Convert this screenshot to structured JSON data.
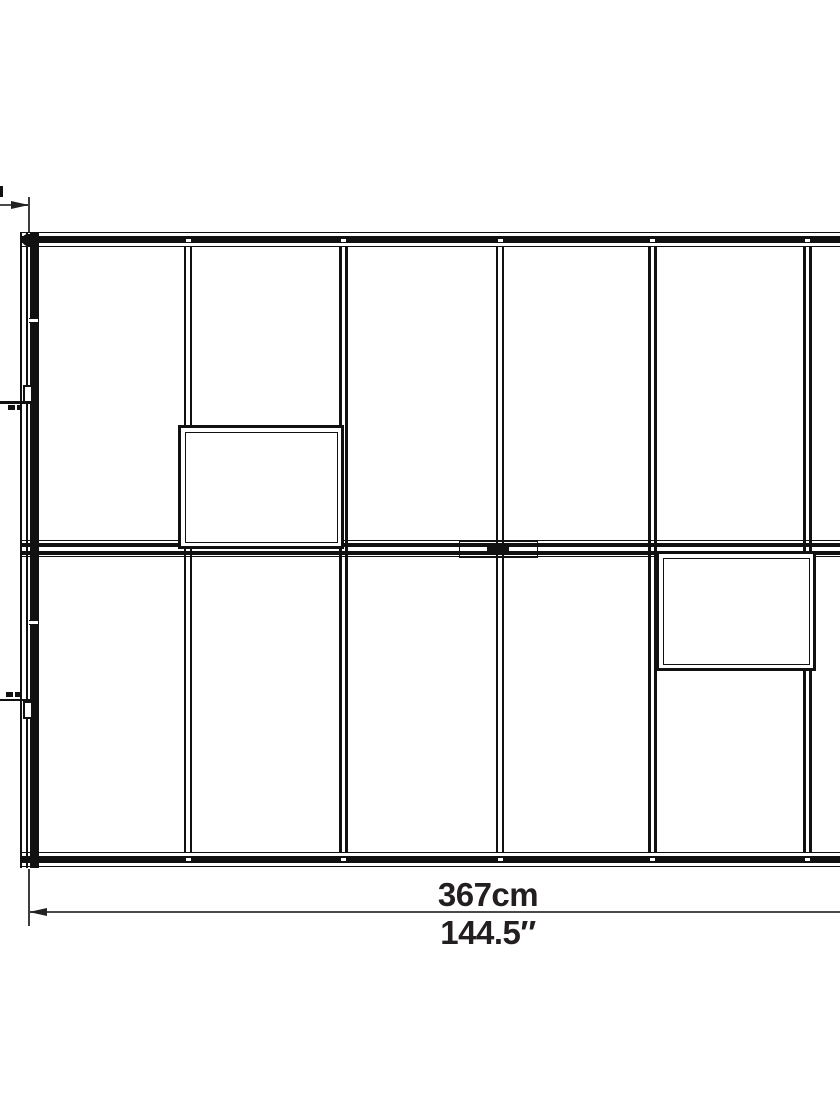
{
  "diagram": {
    "description": "greenhouse-roof-plan-line-drawing",
    "colors": {
      "line": "#111111",
      "dimension_line": "#4a4a4a",
      "label_text": "#231f20",
      "background": "#ffffff"
    },
    "bottom_dimension": {
      "metric": "367cm",
      "imperial": "144.5″"
    }
  }
}
